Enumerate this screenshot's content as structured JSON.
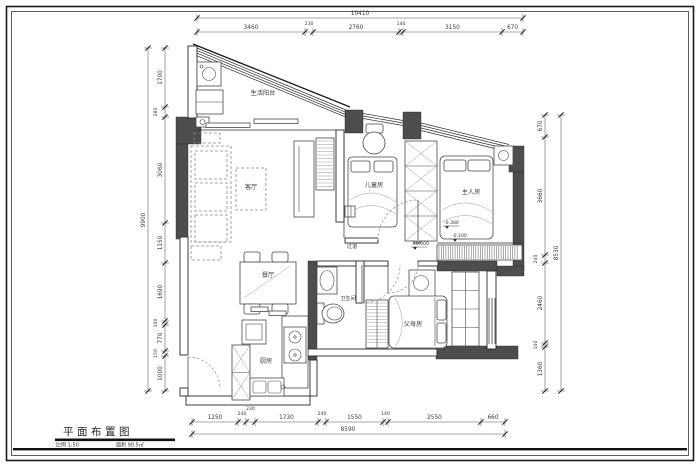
{
  "sheet": {
    "title": "平面布置图",
    "scale": "比例 1:50",
    "area": "面积 90.5㎡"
  },
  "rooms": {
    "balcony": "生活阳台",
    "living": "客厅",
    "dining": "餐厅",
    "kitchen": "厨房",
    "bathroom": "卫生间",
    "hallway": "过道",
    "kids": "儿童房",
    "master": "主人房",
    "parents": "父母房"
  },
  "levels": {
    "band": "-0.300",
    "step": "-0.100",
    "hall": "±0.000"
  },
  "dims": {
    "top": {
      "overall": "10410",
      "segments": [
        "3460",
        "230",
        "2760",
        "140",
        "3150",
        "670"
      ]
    },
    "bottom": {
      "overall": "8590",
      "segments": [
        "1250",
        "240",
        "230",
        "1730",
        "240",
        "1550",
        "140",
        "2550",
        "660"
      ]
    },
    "left": {
      "overall": "9900",
      "segments": [
        "1700",
        "280",
        "3060",
        "1150",
        "1690",
        "100",
        "770",
        "150",
        "1000"
      ]
    },
    "right": {
      "overall": "8530",
      "segments": [
        "670",
        "3660",
        "240",
        "2460",
        "140",
        "1360"
      ]
    }
  }
}
